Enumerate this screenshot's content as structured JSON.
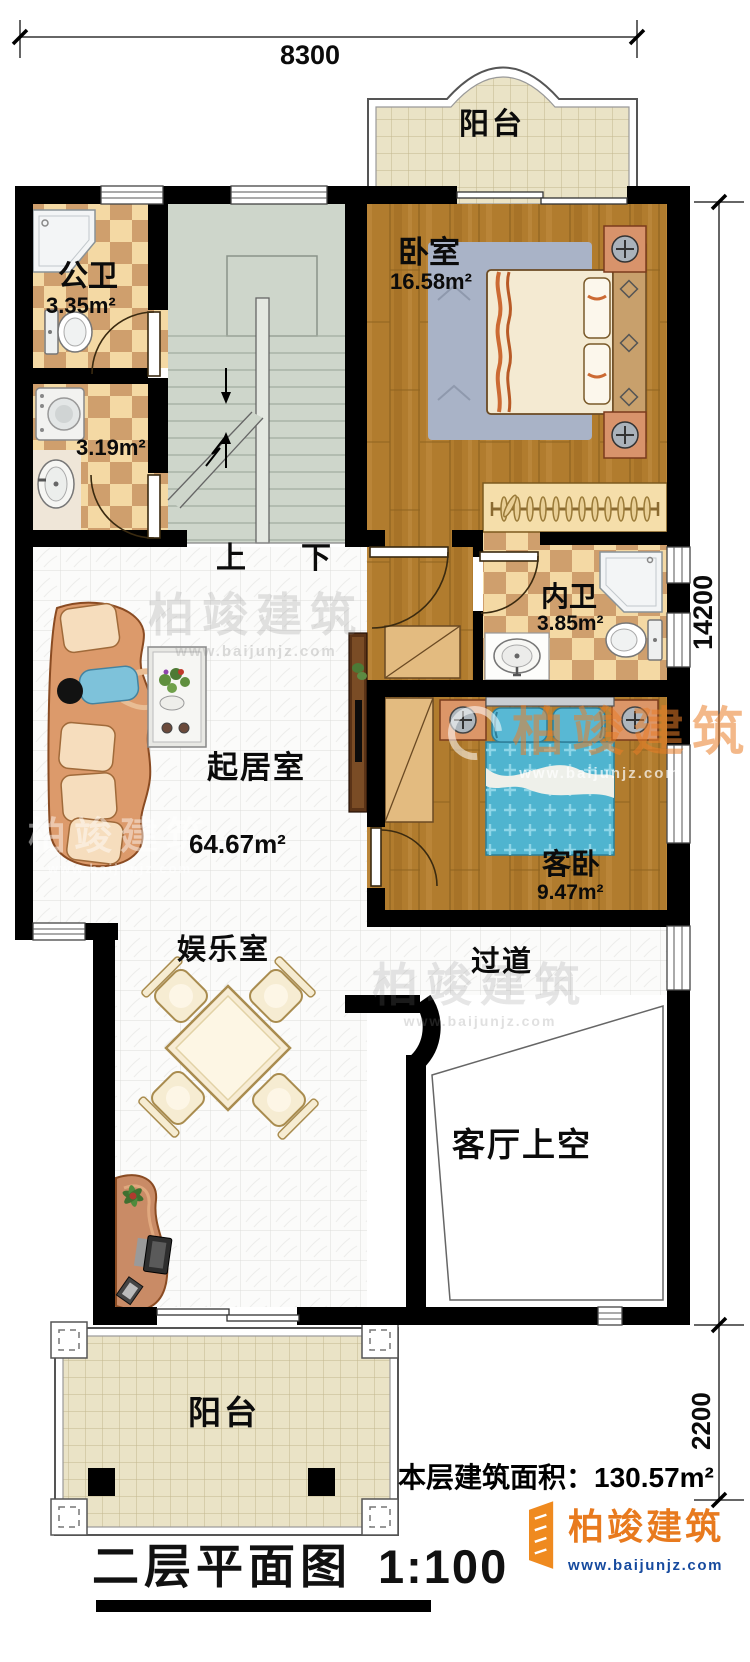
{
  "dims": {
    "width": "8300",
    "height_main": "14200",
    "height_balcony": "2200"
  },
  "rooms": [
    {
      "id": "balcony-top",
      "name": "阳台",
      "area": ""
    },
    {
      "id": "public-bath",
      "name": "公卫",
      "area": "3.35m²"
    },
    {
      "id": "laundry",
      "name": "",
      "area": "3.19m²"
    },
    {
      "id": "bedroom",
      "name": "卧室",
      "area": "16.58m²"
    },
    {
      "id": "inner-bath",
      "name": "内卫",
      "area": "3.85m²"
    },
    {
      "id": "living-room",
      "name": "起居室",
      "area": "64.67m²"
    },
    {
      "id": "guest-bedroom",
      "name": "客卧",
      "area": "9.47m²"
    },
    {
      "id": "entertainment-room",
      "name": "娱乐室",
      "area": ""
    },
    {
      "id": "hallway",
      "name": "过道",
      "area": ""
    },
    {
      "id": "void-over-living",
      "name": "客厅上空",
      "area": ""
    },
    {
      "id": "balcony-bottom",
      "name": "阳台",
      "area": ""
    }
  ],
  "stairs": {
    "up": "上",
    "down": "下"
  },
  "footer": {
    "title": "二层平面图",
    "scale": "1:100",
    "area_label": "本层建筑面积：",
    "area_value": "130.57m²"
  },
  "brand": {
    "name": "柏竣建筑",
    "url": "www.baijunjz.com"
  },
  "colors": {
    "wall": "#000000",
    "wood_floor": "#b17c2e",
    "bath_tile_light": "#f4d9a4",
    "bath_tile_dark": "#cf9f6d",
    "balcony_tile": "#eae3c6",
    "stair": "#ced6cb",
    "guest_bed_blue": "#4fb4cf",
    "sofa": "#dc9a6b",
    "logo_orange": "#e87a1e",
    "logo_blue": "#164a9e"
  }
}
